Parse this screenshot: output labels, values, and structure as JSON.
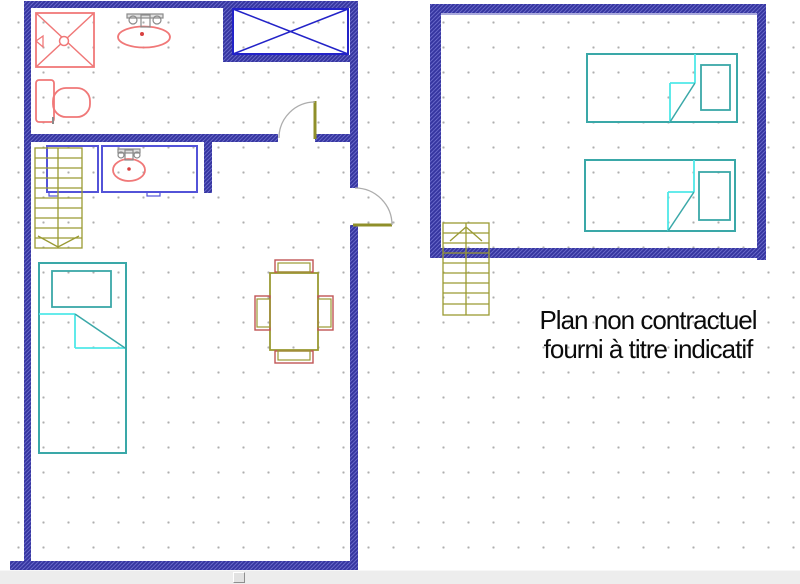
{
  "annotation": {
    "line1": "Plan non contractuel",
    "line2": "fourni à titre indicatif"
  },
  "palette": {
    "wall_dark": "#31319c",
    "wall_light": "#6868c8",
    "wall_inner_edge": "#a9a9dc",
    "window_blue": "#2323c8",
    "cabinet_blue": "#5353d8",
    "fixture_red": "#f07878",
    "drain_red": "#d84040",
    "faucet_gray": "#8a8a8a",
    "door_leaf_olive": "#8f8f2a",
    "door_swing_gray": "#adadad",
    "stairs_olive": "#9a9a33",
    "chair_red": "#c05555",
    "bed_teal": "#3aa8a8",
    "blanket_cyan": "#4fe8e8",
    "grid_dot_gray": "#aeaeae",
    "scrollbar_gray": "#ededed",
    "text_black": "#0b0b0b"
  },
  "scrollbar": {
    "handle_x": 233
  },
  "plan": {
    "walls": [
      {
        "name": "unitA-top-wall",
        "x": 24,
        "y": 1,
        "w": 334,
        "h": 7
      },
      {
        "name": "unitA-left-wall",
        "x": 24,
        "y": 1,
        "w": 7,
        "h": 570
      },
      {
        "name": "unitA-bottom-wall",
        "x": 10,
        "y": 561,
        "w": 348,
        "h": 9
      },
      {
        "name": "unitA-right-wall-upper",
        "x": 350,
        "y": 1,
        "w": 8,
        "h": 187
      },
      {
        "name": "unitA-right-wall-lower",
        "x": 350,
        "y": 225,
        "w": 8,
        "h": 345
      },
      {
        "name": "unitA-interior-wall-west",
        "x": 31,
        "y": 134,
        "w": 247,
        "h": 8
      },
      {
        "name": "unitA-interior-wall-east",
        "x": 315,
        "y": 134,
        "w": 35,
        "h": 8
      },
      {
        "name": "closet-west-wall",
        "x": 223,
        "y": 8,
        "w": 10,
        "h": 47
      },
      {
        "name": "closet-south-wall",
        "x": 223,
        "y": 55,
        "w": 127,
        "h": 7
      },
      {
        "name": "bath2-stub-wall",
        "x": 204,
        "y": 142,
        "w": 8,
        "h": 51
      },
      {
        "name": "unitB-top-wall",
        "x": 430,
        "y": 4,
        "w": 336,
        "h": 9
      },
      {
        "name": "unitB-left-wall",
        "x": 430,
        "y": 4,
        "w": 11,
        "h": 254
      },
      {
        "name": "unitB-right-wall",
        "x": 757,
        "y": 4,
        "w": 9,
        "h": 256
      },
      {
        "name": "unitB-bottom-wall",
        "x": 430,
        "y": 248,
        "w": 336,
        "h": 10
      }
    ],
    "shapes": [
      {
        "name": "unitB-top-wall-inner-edge",
        "kind": "lines",
        "stroke": "#a9a9dc",
        "sw": 2,
        "segs": [
          [
            441,
            14,
            757,
            14
          ]
        ]
      },
      {
        "name": "window-cross-rect",
        "kind": "rect",
        "x": 233,
        "y": 9,
        "w": 115,
        "h": 45,
        "stroke": "#2323c8",
        "sw": 2
      },
      {
        "name": "window-cross-lines",
        "kind": "lines",
        "stroke": "#2323c8",
        "sw": 1.5,
        "segs": [
          [
            233,
            9,
            348,
            54
          ],
          [
            233,
            54,
            348,
            9
          ]
        ]
      },
      {
        "name": "bathroom-door-leaf",
        "kind": "lines",
        "stroke": "#8f8f2a",
        "sw": 3,
        "segs": [
          [
            315,
            101,
            315,
            139
          ]
        ]
      },
      {
        "name": "bathroom-door-swing",
        "kind": "path",
        "d": "M315 102 A36 36 0 0 0 279 138",
        "stroke": "#adadad",
        "sw": 1.3
      },
      {
        "name": "entry-door-leaf",
        "kind": "lines",
        "stroke": "#8f8f2a",
        "sw": 3,
        "segs": [
          [
            353,
            225,
            392,
            225
          ]
        ]
      },
      {
        "name": "entry-door-swing",
        "kind": "path",
        "d": "M392 225 A37 37 0 0 0 355 188",
        "stroke": "#adadad",
        "sw": 1.3
      },
      {
        "name": "cabinet-box",
        "kind": "rect",
        "x": 47,
        "y": 146,
        "w": 51,
        "h": 46,
        "stroke": "#5353d8",
        "sw": 2
      },
      {
        "name": "cabinet-box-tab",
        "kind": "rect",
        "x": 49,
        "y": 192,
        "w": 9,
        "h": 4,
        "stroke": "#5353d8",
        "sw": 1.2
      },
      {
        "name": "vanity-counter",
        "kind": "rect",
        "x": 102,
        "y": 146,
        "w": 95,
        "h": 46,
        "stroke": "#5353d8",
        "sw": 2
      },
      {
        "name": "vanity-counter-tab",
        "kind": "rect",
        "x": 147,
        "y": 192,
        "w": 13,
        "h": 4,
        "stroke": "#5353d8",
        "sw": 1.2
      },
      {
        "name": "vanity-sink-basin",
        "kind": "ellipse",
        "cx": 129,
        "cy": 170,
        "rx": 16,
        "ry": 11,
        "stroke": "#f07878",
        "sw": 1.8
      },
      {
        "name": "vanity-sink-drain",
        "kind": "circle",
        "cx": 129,
        "cy": 169,
        "r": 1.8,
        "fill": "#d84040"
      },
      {
        "name": "vanity-faucet-bar",
        "kind": "rect",
        "x": 118,
        "y": 149,
        "w": 22,
        "h": 4,
        "stroke": "#8a8a8a",
        "sw": 1.2,
        "fill": "#e0e0e0"
      },
      {
        "name": "vanity-faucet-left-knob",
        "kind": "circle",
        "cx": 121,
        "cy": 155,
        "r": 3,
        "stroke": "#8a8a8a",
        "sw": 1.2
      },
      {
        "name": "vanity-faucet-right-knob",
        "kind": "circle",
        "cx": 137,
        "cy": 155,
        "r": 3,
        "stroke": "#8a8a8a",
        "sw": 1.2
      },
      {
        "name": "vanity-faucet-spout",
        "kind": "rect",
        "x": 125,
        "y": 150,
        "w": 8,
        "h": 10,
        "stroke": "#8a8a8a",
        "sw": 1.2
      },
      {
        "name": "shower-tray",
        "kind": "rect",
        "x": 36,
        "y": 13,
        "w": 58,
        "h": 54,
        "stroke": "#f07878",
        "sw": 1.8
      },
      {
        "name": "shower-cross",
        "kind": "lines",
        "stroke": "#f07878",
        "sw": 1.5,
        "segs": [
          [
            36,
            13,
            94,
            67
          ],
          [
            36,
            67,
            94,
            13
          ]
        ]
      },
      {
        "name": "shower-drain",
        "kind": "circle",
        "cx": 64,
        "cy": 41,
        "r": 4.5,
        "stroke": "#f07878",
        "sw": 1.5,
        "fill": "#ffffff"
      },
      {
        "name": "shower-head",
        "kind": "polygon",
        "pts": "43,36 43,47 36,41",
        "stroke": "#f07878",
        "sw": 1.3
      },
      {
        "name": "bath-sink-basin",
        "kind": "ellipse",
        "cx": 144,
        "cy": 37,
        "rx": 26,
        "ry": 10.5,
        "stroke": "#f07878",
        "sw": 1.8
      },
      {
        "name": "bath-sink-drain",
        "kind": "circle",
        "cx": 142,
        "cy": 34,
        "r": 2,
        "fill": "#d84040"
      },
      {
        "name": "bath-faucet-bar",
        "kind": "rect",
        "x": 127,
        "y": 14,
        "w": 36,
        "h": 4,
        "stroke": "#8a8a8a",
        "sw": 1.2,
        "fill": "#e0e0e0"
      },
      {
        "name": "bath-faucet-left-knob",
        "kind": "circle",
        "cx": 133,
        "cy": 20,
        "r": 4,
        "stroke": "#8a8a8a",
        "sw": 1.2
      },
      {
        "name": "bath-faucet-right-knob",
        "kind": "circle",
        "cx": 157,
        "cy": 20,
        "r": 4,
        "stroke": "#8a8a8a",
        "sw": 1.2
      },
      {
        "name": "bath-faucet-spout",
        "kind": "rect",
        "x": 141,
        "y": 15,
        "w": 9,
        "h": 12,
        "stroke": "#8a8a8a",
        "sw": 1.2
      },
      {
        "name": "toilet-tank",
        "kind": "rect",
        "x": 36,
        "y": 80,
        "w": 18,
        "h": 42,
        "rx": 3,
        "stroke": "#f07878",
        "sw": 1.8
      },
      {
        "name": "toilet-bowl",
        "kind": "rect",
        "x": 53,
        "y": 88,
        "w": 37,
        "h": 29,
        "rx": 13,
        "stroke": "#f07878",
        "sw": 1.8
      },
      {
        "name": "toilet-hinge",
        "kind": "lines",
        "stroke": "#8a8a8a",
        "sw": 2,
        "segs": [
          [
            53,
            117,
            53,
            124
          ]
        ]
      },
      {
        "name": "dining-table",
        "kind": "rect",
        "x": 270,
        "y": 273,
        "w": 48,
        "h": 77,
        "stroke": "#9a9a33",
        "sw": 1.8
      },
      {
        "name": "chair-north-outer",
        "kind": "rect",
        "x": 275,
        "y": 260,
        "w": 38,
        "h": 12,
        "stroke": "#c05555",
        "sw": 1.4
      },
      {
        "name": "chair-north-inner",
        "kind": "rect",
        "x": 278,
        "y": 263,
        "w": 32,
        "h": 9,
        "stroke": "#9a9a33",
        "sw": 1.2
      },
      {
        "name": "chair-south-outer",
        "kind": "rect",
        "x": 275,
        "y": 351,
        "w": 38,
        "h": 12,
        "stroke": "#c05555",
        "sw": 1.4
      },
      {
        "name": "chair-south-inner",
        "kind": "rect",
        "x": 278,
        "y": 351,
        "w": 32,
        "h": 9,
        "stroke": "#9a9a33",
        "sw": 1.2
      },
      {
        "name": "chair-west-outer",
        "kind": "rect",
        "x": 255,
        "y": 296,
        "w": 15,
        "h": 34,
        "stroke": "#c05555",
        "sw": 1.4
      },
      {
        "name": "chair-west-inner",
        "kind": "rect",
        "x": 257,
        "y": 299,
        "w": 13,
        "h": 28,
        "stroke": "#9a9a33",
        "sw": 1.2
      },
      {
        "name": "chair-east-outer",
        "kind": "rect",
        "x": 318,
        "y": 296,
        "w": 15,
        "h": 34,
        "stroke": "#c05555",
        "sw": 1.4
      },
      {
        "name": "chair-east-inner",
        "kind": "rect",
        "x": 318,
        "y": 299,
        "w": 13,
        "h": 28,
        "stroke": "#9a9a33",
        "sw": 1.2
      },
      {
        "name": "bed-left-frame",
        "kind": "rect",
        "x": 39,
        "y": 263,
        "w": 87,
        "h": 190,
        "stroke": "#3aa8a8",
        "sw": 2
      },
      {
        "name": "bed-left-pillow",
        "kind": "rect",
        "x": 52,
        "y": 271,
        "w": 59,
        "h": 36,
        "stroke": "#3aa8a8",
        "sw": 1.8
      },
      {
        "name": "bed-left-blanket",
        "kind": "lines",
        "stroke": "#4fe8e8",
        "sw": 1.8,
        "segs": [
          [
            39,
            314,
            75,
            314
          ],
          [
            75,
            314,
            75,
            348
          ],
          [
            75,
            348,
            125,
            348
          ]
        ]
      },
      {
        "name": "bed-left-blanket-fold",
        "kind": "lines",
        "stroke": "#3aa8a8",
        "sw": 1.5,
        "segs": [
          [
            75,
            314,
            125,
            348
          ]
        ]
      },
      {
        "name": "bed-top-frame",
        "kind": "rect",
        "x": 587,
        "y": 54,
        "w": 150,
        "h": 68,
        "stroke": "#3aa8a8",
        "sw": 2
      },
      {
        "name": "bed-top-pillow",
        "kind": "rect",
        "x": 701,
        "y": 65,
        "w": 29,
        "h": 45,
        "stroke": "#3aa8a8",
        "sw": 1.8
      },
      {
        "name": "bed-top-blanket",
        "kind": "lines",
        "stroke": "#4fe8e8",
        "sw": 1.8,
        "segs": [
          [
            695,
            54,
            695,
            83
          ],
          [
            670,
            83,
            695,
            83
          ],
          [
            670,
            83,
            670,
            122
          ]
        ]
      },
      {
        "name": "bed-top-blanket-fold",
        "kind": "lines",
        "stroke": "#3aa8a8",
        "sw": 1.5,
        "segs": [
          [
            670,
            122,
            695,
            83
          ]
        ]
      },
      {
        "name": "bed-bottom-frame",
        "kind": "rect",
        "x": 585,
        "y": 160,
        "w": 150,
        "h": 71,
        "stroke": "#3aa8a8",
        "sw": 2
      },
      {
        "name": "bed-bottom-pillow",
        "kind": "rect",
        "x": 699,
        "y": 172,
        "w": 31,
        "h": 48,
        "stroke": "#3aa8a8",
        "sw": 1.8
      },
      {
        "name": "bed-bottom-blanket",
        "kind": "lines",
        "stroke": "#4fe8e8",
        "sw": 1.8,
        "segs": [
          [
            694,
            160,
            694,
            192
          ],
          [
            668,
            192,
            694,
            192
          ],
          [
            668,
            192,
            668,
            231
          ]
        ]
      },
      {
        "name": "bed-bottom-blanket-fold",
        "kind": "lines",
        "stroke": "#3aa8a8",
        "sw": 1.5,
        "segs": [
          [
            668,
            231,
            694,
            192
          ]
        ]
      },
      {
        "name": "stairs-left-outline",
        "kind": "rect",
        "x": 35,
        "y": 148,
        "w": 47,
        "h": 100,
        "stroke": "#9a9a33",
        "sw": 1.3
      },
      {
        "name": "stairs-left-rail",
        "kind": "lines",
        "stroke": "#9a9a33",
        "sw": 1.3,
        "segs": [
          [
            58,
            148,
            58,
            248
          ]
        ]
      },
      {
        "name": "stairs-left-treads",
        "kind": "lines",
        "stroke": "#9a9a33",
        "sw": 1.2,
        "segs": [
          [
            35,
            158,
            82,
            158
          ],
          [
            35,
            168,
            82,
            168
          ],
          [
            35,
            178,
            82,
            178
          ],
          [
            35,
            188,
            82,
            188
          ],
          [
            35,
            198,
            82,
            198
          ],
          [
            35,
            208,
            82,
            208
          ],
          [
            35,
            218,
            82,
            218
          ],
          [
            35,
            228,
            82,
            228
          ],
          [
            35,
            238,
            82,
            238
          ]
        ]
      },
      {
        "name": "stairs-left-direction-arrow",
        "kind": "polyline",
        "pts": "38,236 58,247 79,236",
        "stroke": "#9a9a33",
        "sw": 1.3
      },
      {
        "name": "stairs-right-outline",
        "kind": "rect",
        "x": 443,
        "y": 223,
        "w": 46,
        "h": 92,
        "stroke": "#9a9a33",
        "sw": 1.3
      },
      {
        "name": "stairs-right-rail",
        "kind": "lines",
        "stroke": "#9a9a33",
        "sw": 1.3,
        "segs": [
          [
            466,
            223,
            466,
            315
          ]
        ]
      },
      {
        "name": "stairs-right-treads",
        "kind": "lines",
        "stroke": "#9a9a33",
        "sw": 1.2,
        "segs": [
          [
            443,
            233,
            489,
            233
          ],
          [
            443,
            243,
            489,
            243
          ],
          [
            443,
            253,
            489,
            253
          ],
          [
            443,
            263,
            489,
            263
          ],
          [
            443,
            273,
            489,
            273
          ],
          [
            443,
            283,
            489,
            283
          ],
          [
            443,
            293,
            489,
            293
          ],
          [
            443,
            304,
            489,
            304
          ]
        ]
      },
      {
        "name": "stairs-right-direction-arrow",
        "kind": "polyline",
        "pts": "450,241 466,227 482,241",
        "stroke": "#9a9a33",
        "sw": 1.3
      }
    ]
  }
}
